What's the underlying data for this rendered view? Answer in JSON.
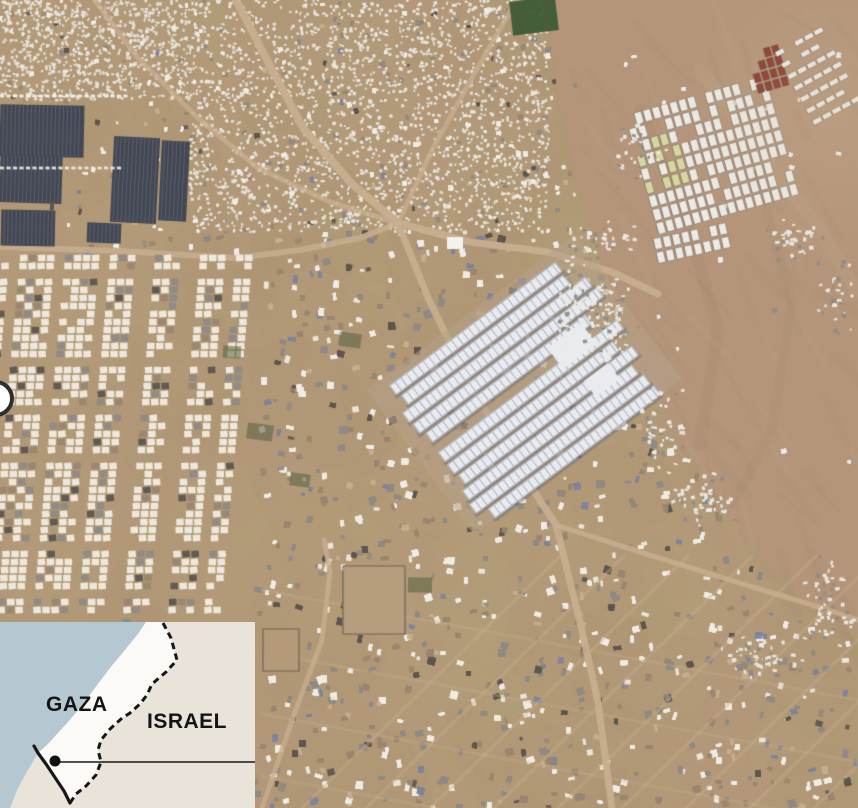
{
  "inset_map": {
    "labels": {
      "gaza": "GAZA",
      "israel": "ISRAEL"
    },
    "colors": {
      "sea": "#b5c8d2",
      "land": "#e9e3da",
      "gaza_strip": "#fbfaf7",
      "border": "#17171a",
      "marker_dot": "#121215",
      "leader_line": "#17171a"
    }
  },
  "location_marker": {
    "fill": "#ffffff",
    "ring": "#2e2e30"
  },
  "satellite": {
    "colors": {
      "sand_base": "#b29878",
      "sand_light": "#c6ad8d",
      "dune": "#b4957a",
      "dune_shadow": "#9c8266",
      "road": "#c7ae8e",
      "building_white": "#efece4",
      "building_gray": "#8e8a86",
      "building_brown": "#9a8670",
      "building_dark": "#5c564f",
      "building_blue": "#7d849c",
      "greenhouse": "#444852",
      "greenhouse_stripe": "#5a6070",
      "warehouse_roof": "#e9ebef",
      "warehouse_line": "#aab1bc",
      "warehouse_shadow": "#62656e",
      "tent_white": "#eceae4",
      "tent_yellow": "#d6d7a0",
      "tent_red": "#8a3c2d",
      "field_green": "#3f5a35"
    }
  }
}
